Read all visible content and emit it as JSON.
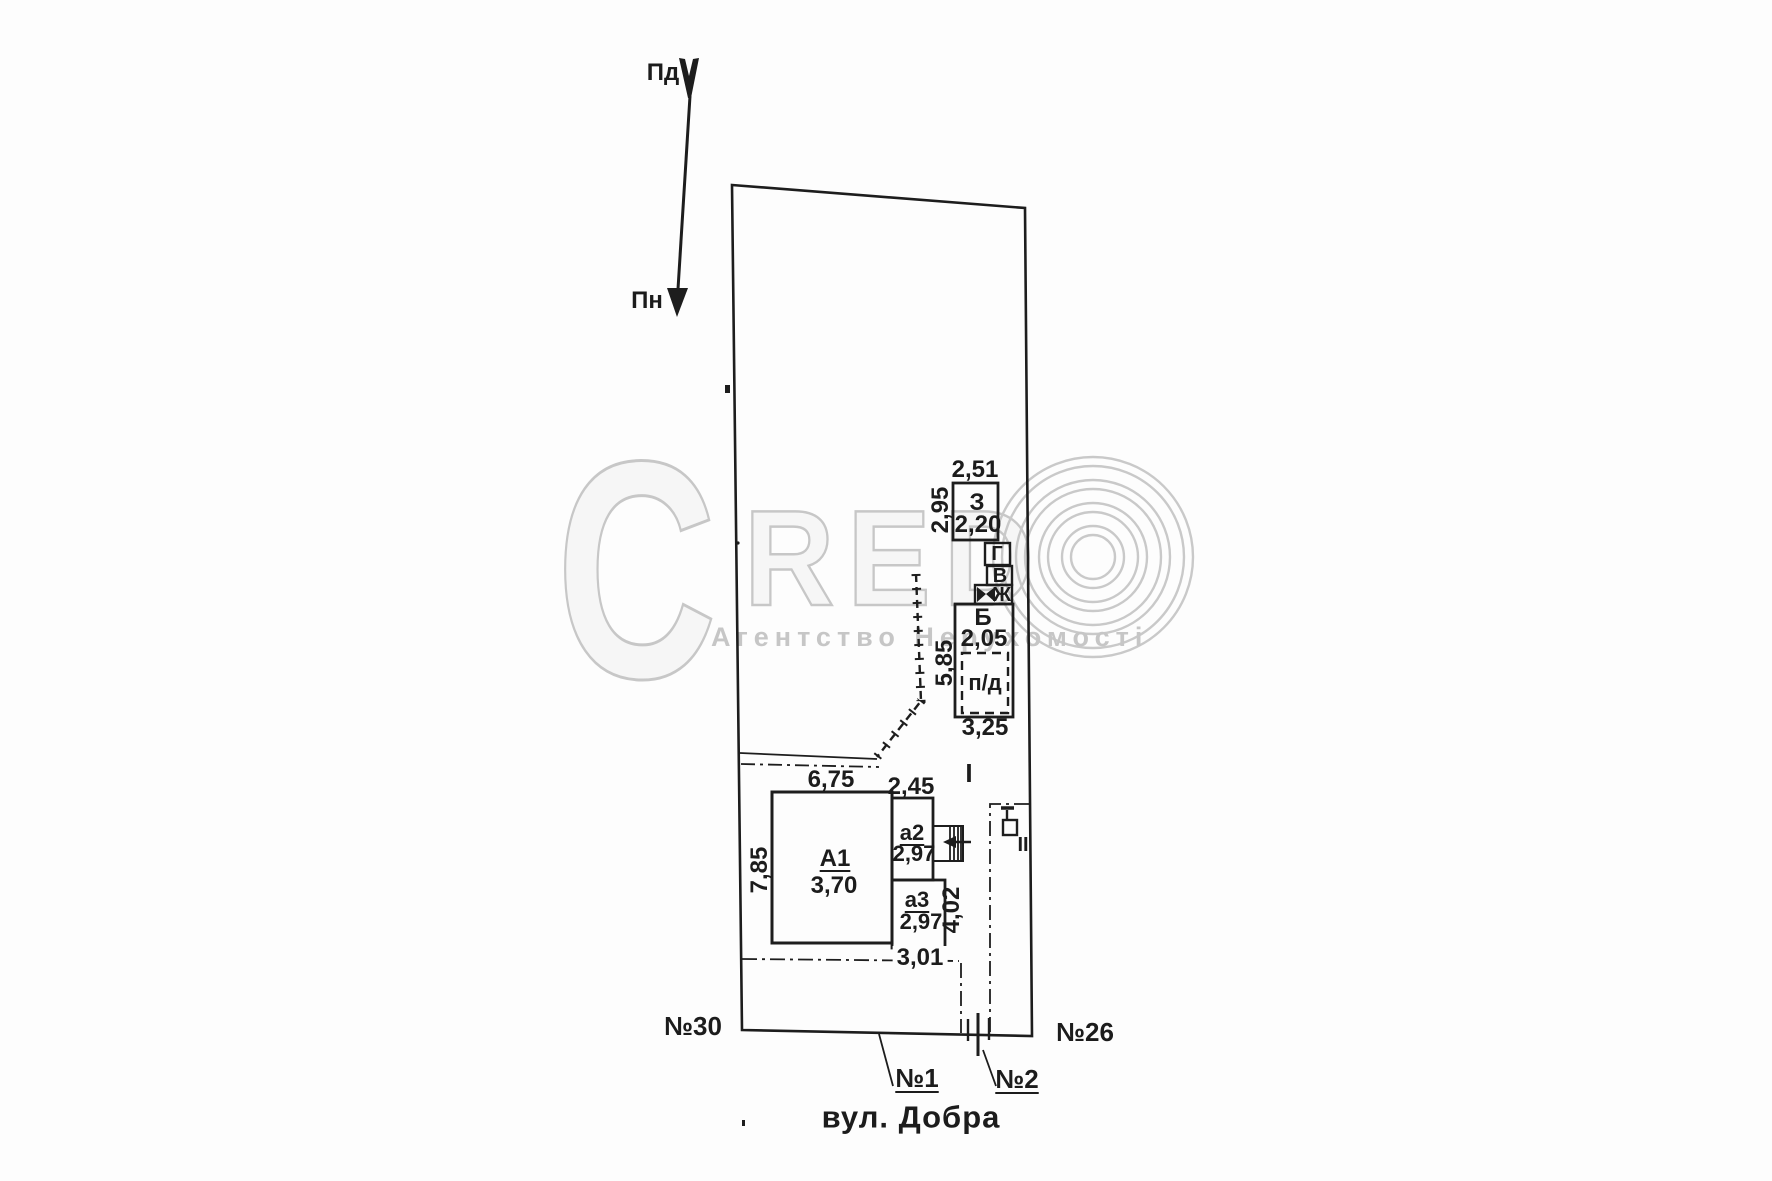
{
  "plan": {
    "compass": {
      "south_label": "Пд",
      "north_label": "Пн"
    },
    "buildings": {
      "a1": {
        "code": "А1",
        "mark": "3,70"
      },
      "a2": {
        "code": "а2",
        "mark": "2,97"
      },
      "a3": {
        "code": "а3",
        "mark": "2,97"
      },
      "b": {
        "code": "Б",
        "mark": "2,05"
      },
      "z": {
        "code": "З",
        "mark": "2,20"
      },
      "g": {
        "code": "Г"
      },
      "v": {
        "code": "В"
      },
      "zh": {
        "code": "Ж"
      },
      "pd": {
        "code": "п/д"
      }
    },
    "dimensions": {
      "z_top": "2,51",
      "z_side": "2,95",
      "b_side": "5,85",
      "b_bottom": "3,25",
      "a1_top": "6,75",
      "a1_side": "7,85",
      "a2_top": "2,45",
      "a3_side": "4,02",
      "setback_bottom": "3,01"
    },
    "markers": {
      "section_1": "І",
      "section_2": "ІІ"
    },
    "neighbors": {
      "left": "№30",
      "right": "№26"
    },
    "gates": {
      "gate_1": "№1",
      "gate_2": "№2"
    },
    "street_label": "вул. Добра"
  },
  "watermark": {
    "big_c": "C",
    "red_letters": "RED",
    "agency": "Агентство Нерухомості"
  },
  "colors": {
    "ink": "#1d1d1d",
    "watermark_gray": "#c7c7c7"
  }
}
